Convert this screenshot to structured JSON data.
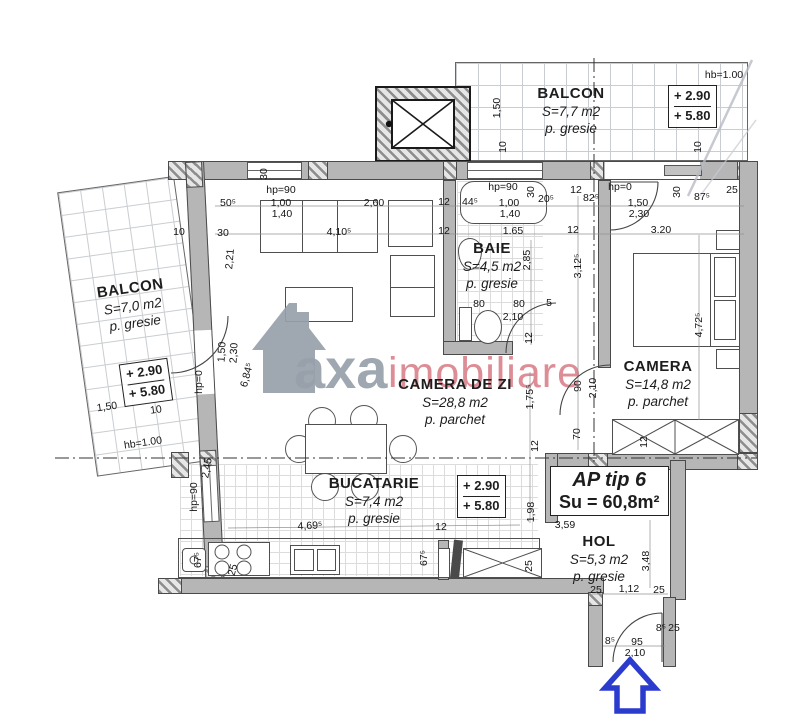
{
  "brand": {
    "gray": "axa",
    "red": "imobiliare"
  },
  "title_box": {
    "line1": "AP tip 6",
    "line2": "Su = 60,8m²"
  },
  "rooms": {
    "balcon_top": {
      "name": "BALCON",
      "area": "S=7,7 m2",
      "floor": "p. gresie"
    },
    "balcon_left": {
      "name": "BALCON",
      "area": "S=7,0 m2",
      "floor": "p. gresie"
    },
    "living": {
      "name": "CAMERA DE ZI",
      "area": "S=28,8 m2",
      "floor": "p. parchet"
    },
    "baie": {
      "name": "BAIE",
      "area": "S=4,5 m2",
      "floor": "p. gresie"
    },
    "camera": {
      "name": "CAMERA",
      "area": "S=14,8 m2",
      "floor": "p. parchet"
    },
    "bucatarie": {
      "name": "BUCATARIE",
      "area": "S=7,4 m2",
      "floor": "p. gresie"
    },
    "hol": {
      "name": "HOL",
      "area": "S=5,3 m2",
      "floor": "p. gresie"
    }
  },
  "level_markers": {
    "balcon_top": {
      "l1": "+ 2.90",
      "l2": "+ 5.80"
    },
    "balcon_left": {
      "l1": "+ 2.90",
      "l2": "+ 5.80"
    },
    "bucatarie": {
      "l1": "+ 2.90",
      "l2": "+ 5.80"
    }
  },
  "colors": {
    "wall": "#b6b6b6",
    "brand_gray": "#97a1aa",
    "brand_red": "#d4717c",
    "arrow_blue": "#2b3bcd"
  },
  "dimensions": [
    {
      "t": "hb=1.00",
      "x": 724,
      "y": 75,
      "r": 0
    },
    {
      "t": "1,50",
      "x": 497,
      "y": 108,
      "r": -90
    },
    {
      "t": "10",
      "x": 503,
      "y": 147,
      "r": -90
    },
    {
      "t": "10",
      "x": 698,
      "y": 147,
      "r": -90
    },
    {
      "t": "hp=90",
      "x": 281,
      "y": 190,
      "r": 0
    },
    {
      "t": "50⁵",
      "x": 228,
      "y": 203,
      "r": 0
    },
    {
      "t": "1,00",
      "x": 281,
      "y": 203,
      "r": 0
    },
    {
      "t": "1,40",
      "x": 282,
      "y": 214,
      "r": 0
    },
    {
      "t": "2,60",
      "x": 374,
      "y": 203,
      "r": 0
    },
    {
      "t": "12",
      "x": 444,
      "y": 202,
      "r": 0
    },
    {
      "t": "44⁵",
      "x": 470,
      "y": 202,
      "r": 0
    },
    {
      "t": "hp=90",
      "x": 503,
      "y": 187,
      "r": 0
    },
    {
      "t": "1,00",
      "x": 509,
      "y": 203,
      "r": 0
    },
    {
      "t": "1,40",
      "x": 510,
      "y": 214,
      "r": 0
    },
    {
      "t": "20⁵",
      "x": 546,
      "y": 199,
      "r": 0
    },
    {
      "t": "30",
      "x": 531,
      "y": 192,
      "r": -90
    },
    {
      "t": "12",
      "x": 576,
      "y": 190,
      "r": 0
    },
    {
      "t": "82⁵",
      "x": 591,
      "y": 198,
      "r": 0
    },
    {
      "t": "hp=0",
      "x": 620,
      "y": 187,
      "r": 0
    },
    {
      "t": "1,50",
      "x": 638,
      "y": 203,
      "r": 0
    },
    {
      "t": "2,30",
      "x": 639,
      "y": 214,
      "r": 0
    },
    {
      "t": "30",
      "x": 677,
      "y": 192,
      "r": -90
    },
    {
      "t": "87⁵",
      "x": 702,
      "y": 197,
      "r": 0
    },
    {
      "t": "25",
      "x": 732,
      "y": 190,
      "r": 0
    },
    {
      "t": "10",
      "x": 179,
      "y": 232,
      "r": 0
    },
    {
      "t": "30",
      "x": 223,
      "y": 233,
      "r": 0
    },
    {
      "t": "30",
      "x": 264,
      "y": 174,
      "r": -90
    },
    {
      "t": "4,10⁵",
      "x": 339,
      "y": 232,
      "r": 0
    },
    {
      "t": "12",
      "x": 444,
      "y": 231,
      "r": 0
    },
    {
      "t": "1.65",
      "x": 513,
      "y": 231,
      "r": 0
    },
    {
      "t": "12",
      "x": 573,
      "y": 230,
      "r": 0
    },
    {
      "t": "3.20",
      "x": 661,
      "y": 230,
      "r": 0
    },
    {
      "t": "2,21",
      "x": 230,
      "y": 259,
      "r": -85
    },
    {
      "t": "1,50",
      "x": 222,
      "y": 352,
      "r": -87
    },
    {
      "t": "2,30",
      "x": 234,
      "y": 353,
      "r": -87
    },
    {
      "t": "hp=0",
      "x": 199,
      "y": 382,
      "r": -90
    },
    {
      "t": "6,84⁵",
      "x": 247,
      "y": 375,
      "r": -75
    },
    {
      "t": "2,85",
      "x": 527,
      "y": 260,
      "r": -90
    },
    {
      "t": "3,12⁵",
      "x": 578,
      "y": 266,
      "r": -90
    },
    {
      "t": "80",
      "x": 479,
      "y": 304,
      "r": 0
    },
    {
      "t": "80",
      "x": 519,
      "y": 304,
      "r": 0
    },
    {
      "t": "5",
      "x": 549,
      "y": 303,
      "r": 0
    },
    {
      "t": "2,10",
      "x": 513,
      "y": 317,
      "r": 0
    },
    {
      "t": "12",
      "x": 529,
      "y": 338,
      "r": -90
    },
    {
      "t": "4,72⁵",
      "x": 699,
      "y": 325,
      "r": -90
    },
    {
      "t": "90",
      "x": 578,
      "y": 386,
      "r": -90
    },
    {
      "t": "2,10",
      "x": 593,
      "y": 388,
      "r": -90
    },
    {
      "t": "70",
      "x": 577,
      "y": 434,
      "r": -90
    },
    {
      "t": "12",
      "x": 644,
      "y": 442,
      "r": -90
    },
    {
      "t": "1,75⁵",
      "x": 530,
      "y": 397,
      "r": -90
    },
    {
      "t": "12",
      "x": 535,
      "y": 446,
      "r": -90
    },
    {
      "t": "2,45",
      "x": 207,
      "y": 468,
      "r": -80
    },
    {
      "t": "hp=90",
      "x": 194,
      "y": 497,
      "r": -90
    },
    {
      "t": "4,69⁵",
      "x": 310,
      "y": 526,
      "r": -3
    },
    {
      "t": "1,98",
      "x": 531,
      "y": 512,
      "r": -90
    },
    {
      "t": "12",
      "x": 441,
      "y": 527,
      "r": 0
    },
    {
      "t": "67⁵",
      "x": 424,
      "y": 558,
      "r": -90
    },
    {
      "t": "25",
      "x": 529,
      "y": 566,
      "r": -90
    },
    {
      "t": "25",
      "x": 233,
      "y": 570,
      "r": -75
    },
    {
      "t": "67⁵",
      "x": 198,
      "y": 560,
      "r": -90
    },
    {
      "t": "3,59",
      "x": 565,
      "y": 525,
      "r": 0
    },
    {
      "t": "3,48",
      "x": 646,
      "y": 561,
      "r": -90
    },
    {
      "t": "25",
      "x": 596,
      "y": 590,
      "r": 0
    },
    {
      "t": "1,12",
      "x": 629,
      "y": 589,
      "r": 0
    },
    {
      "t": "25",
      "x": 659,
      "y": 590,
      "r": 0
    },
    {
      "t": "8⁵",
      "x": 610,
      "y": 641,
      "r": 0
    },
    {
      "t": "95",
      "x": 637,
      "y": 642,
      "r": 0
    },
    {
      "t": "2,10",
      "x": 635,
      "y": 653,
      "r": 0
    },
    {
      "t": "8⁵",
      "x": 661,
      "y": 628,
      "r": 0
    },
    {
      "t": "25",
      "x": 674,
      "y": 628,
      "r": 0
    },
    {
      "t": "1,50",
      "x": 107,
      "y": 407,
      "r": -8
    },
    {
      "t": "10",
      "x": 156,
      "y": 410,
      "r": -8
    },
    {
      "t": "hb=1.00",
      "x": 143,
      "y": 443,
      "r": -8
    }
  ]
}
